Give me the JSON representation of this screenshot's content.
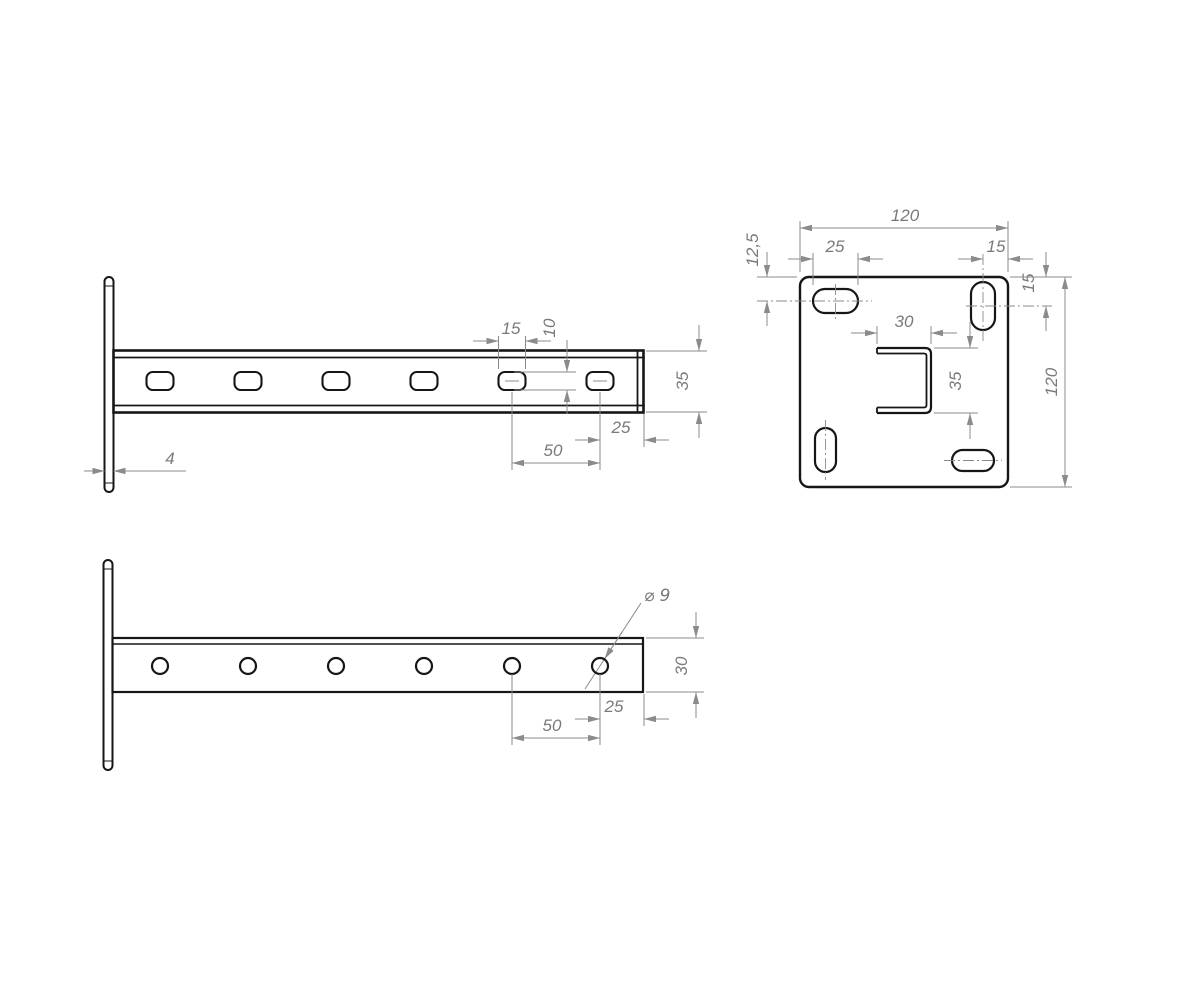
{
  "colors": {
    "background": "#ffffff",
    "part_line": "#161616",
    "dim_line": "#8b8b8b",
    "dim_text": "#7a7a7a"
  },
  "views": {
    "side": {
      "dims": {
        "slot_length": "15",
        "slot_height": "10",
        "profile_height": "35",
        "end_to_last_hole": "25",
        "hole_pitch": "50",
        "plate_thickness": "4"
      }
    },
    "plate": {
      "dims": {
        "width": "120",
        "height": "120",
        "slot_length": "25",
        "slot_center_to_edge": "15",
        "top_edge_to_slot_center": "12,5",
        "right_edge_to_slot_center": "15",
        "channel_width": "30",
        "channel_height": "35"
      }
    },
    "plan": {
      "dims": {
        "hole_diameter": "⌀ 9",
        "strip_width": "30",
        "end_to_last_hole": "25",
        "hole_pitch": "50"
      }
    }
  }
}
